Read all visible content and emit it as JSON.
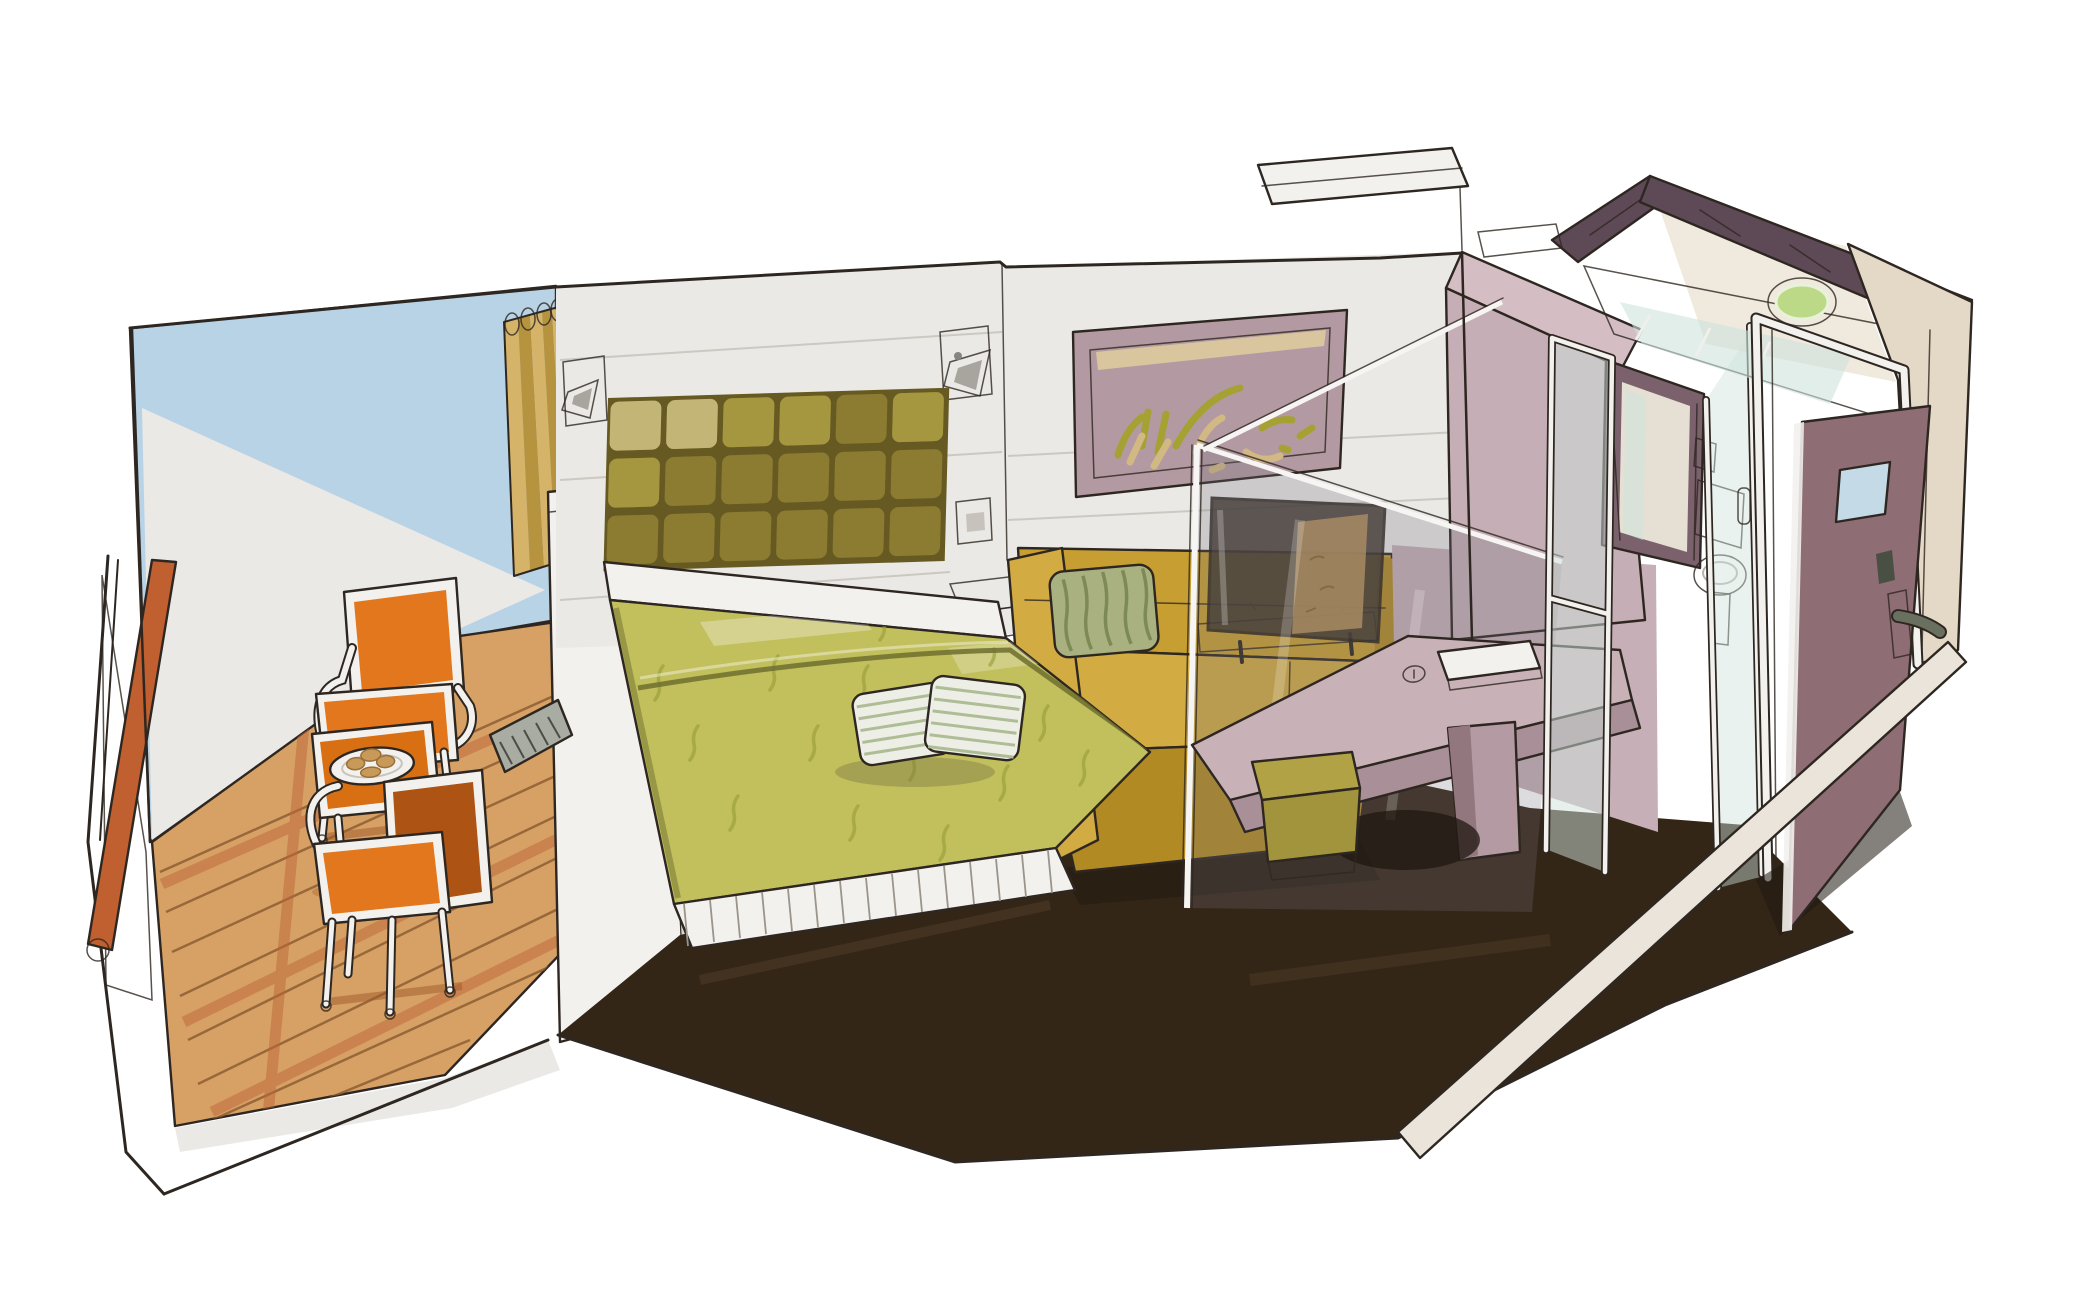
{
  "scene": {
    "medium": "ink and marker concept sketch",
    "subject": "hotel / cruise cabin cutaway with private balcony",
    "view": "isometric cutaway perspective",
    "description": "Hand-drawn cutaway illustration of a cabin: balcony with two orange chairs and breakfast table, bedroom with tufted olive headboard and chartreuse bed, mustard sofa with TV behind a glass partition, writing desk with cube stool, bathroom with toilet, glass shower and vessel sink, and an open entry door"
  },
  "objects": [
    {
      "id": "balcony",
      "label": "balcony with wood deck"
    },
    {
      "id": "handrail",
      "label": "terracotta handrail"
    },
    {
      "id": "chairs",
      "label": "two orange armchairs"
    },
    {
      "id": "table",
      "label": "bistro table with breakfast plate"
    },
    {
      "id": "curtain",
      "label": "gold curtain"
    },
    {
      "id": "headboard",
      "label": "tufted olive headboard"
    },
    {
      "id": "bed",
      "label": "double bed with chartreuse bedspread and striped pillows"
    },
    {
      "id": "sconces",
      "label": "two wall sconce lamps"
    },
    {
      "id": "art",
      "label": "abstract framed artwork"
    },
    {
      "id": "nightstand",
      "label": "floating nightstand shelf"
    },
    {
      "id": "sofa",
      "label": "mustard sofa with green striped cushion"
    },
    {
      "id": "tv",
      "label": "flat screen TV on low stand"
    },
    {
      "id": "glass-partition",
      "label": "tilted glass partition"
    },
    {
      "id": "desk",
      "label": "writing desk with folder and mouse"
    },
    {
      "id": "stool",
      "label": "olive cube stool"
    },
    {
      "id": "bathroom",
      "label": "bathroom with toilet, glass shower and green vessel sink"
    },
    {
      "id": "door",
      "label": "open entry door with small window and lever handle"
    },
    {
      "id": "floor",
      "label": "dark brown carpet"
    },
    {
      "id": "slab",
      "label": "cutaway floor slab edge"
    }
  ],
  "palette": {
    "ink": "#2e2721",
    "paper_white": "#f3f1ee",
    "wall_white": "#ebe9e6",
    "wall_line": "#c9c4be",
    "balcony_sky": "#b9d3e6",
    "balcony_glass": "#d6e5ea",
    "window_glass": "#dfe9ec",
    "handrail_terracotta": "#c05f30",
    "deck_wood": "#d7a166",
    "deck_plank": "#8a5a30",
    "deck_stripe": "#bd6636",
    "deck_shadow": "#a05a28",
    "chair_orange": "#e2771d",
    "chair_orange_dark": "#ad5313",
    "table_orange": "#d86f12",
    "croissant_tan": "#c89a59",
    "curtain_gold": "#d5b469",
    "curtain_gold_dark": "#b6933f",
    "grille_grey": "#a8aca2",
    "column_side": "#d9d6d2",
    "headboard_seam": "#665a22",
    "headboard_olive": "#8b7c31",
    "headboard_light": "#a59640",
    "headboard_pale": "#c3b576",
    "bedspread_green": "#c2bf5d",
    "bedspread_pattern": "#99a03b",
    "bedspread_fold": "#6e6f2e",
    "pillow_white": "#edeee5",
    "pillow_stripe": "#aebd96",
    "pillow_shadow": "#6e6e40",
    "floor_brown": "#342617",
    "floor_streak": "#5a452c",
    "shadow_dark": "#1f1710",
    "sofa_mustard": "#c79e31",
    "sofa_light": "#d2ab42",
    "sofa_dark": "#b18a24",
    "cushion_green": "#a9b180",
    "cushion_stripe": "#7d8a56",
    "nightstand_top": "#b3aba5",
    "nightstand_front": "#8e8680",
    "switch_panel": "#6b655f",
    "switch_inner": "#c8c2bc",
    "art_frame_mauve": "#b39aa2",
    "art_cream": "#e7d49c",
    "art_olive": "#a5a132",
    "art_tan": "#d2b983",
    "sconce_shade": "#d8d4ce",
    "sconce_inner": "#a8a49e",
    "glass_tint": "rgba(115,112,122,0.25)",
    "glass_edge": "#f6f5f3",
    "tv_dark": "#3a322a",
    "tv_tan": "#c0995c",
    "tv_shelf": "#ddd8d0",
    "corridor_mauve": "#c6afb6",
    "desk_top": "#c8b2b8",
    "desk_edge": "#a98f98",
    "desk_pedestal": "#b49aa2",
    "book_side": "#d9d5cf",
    "stool_olive": "#b0a245",
    "stool_dark": "#a2943c",
    "stool_base": "#b9a2aa",
    "wedge_light": "#d4bec4",
    "wedge_mauve": "#c5aeb5",
    "roof_plum": "#5d4a56",
    "bath_inner_mauve": "#8d7380",
    "bath_glass_aqua": "#cfe2dc",
    "doorway_jamb": "#7a616c",
    "doorway_interior": "#e6e0d4",
    "flush_plate": "#eae6e0",
    "sink_green": "#bcd988",
    "beige_wall": "#e4d8c6",
    "beige_light": "#eee7da",
    "door_brown": "#8f6d74",
    "door_window_blue": "#c4dae6",
    "handle_plate": "#b8b8ac",
    "handle_metal": "#6a7060",
    "lock_dark": "#4a4f44",
    "slab_beige": "#eae4da",
    "sheen_white": "#ffffff"
  }
}
